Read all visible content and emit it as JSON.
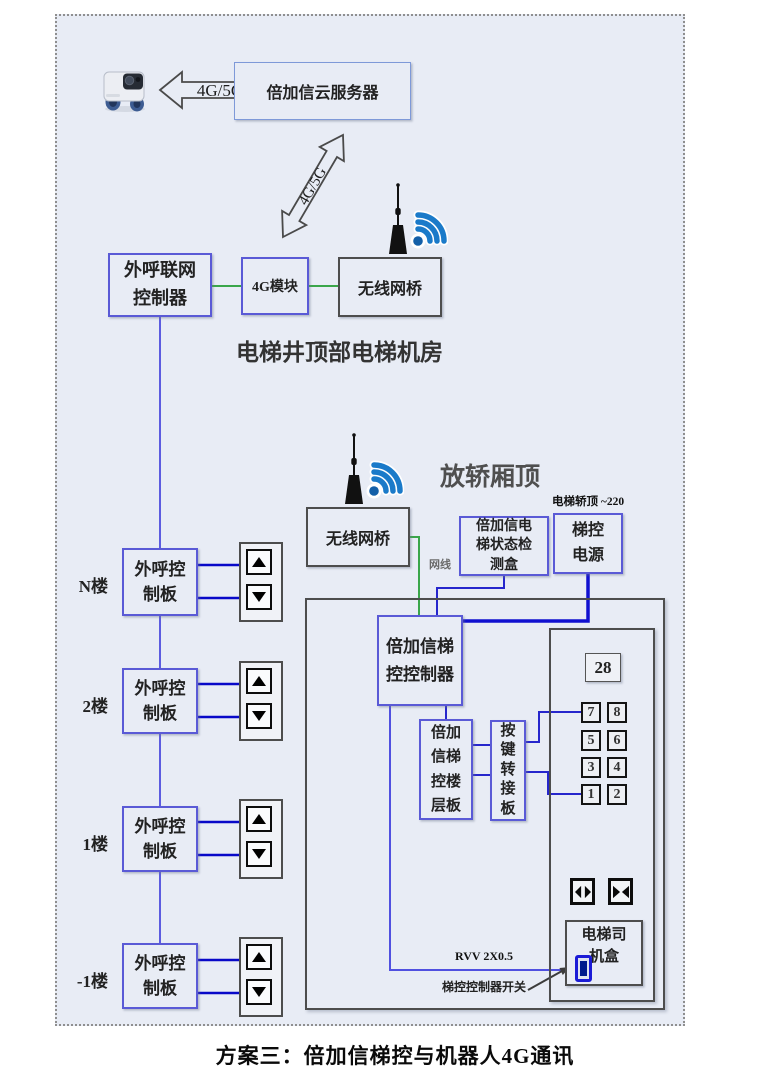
{
  "caption": "方案三：倍加信梯控与机器人4G通讯",
  "cloud": {
    "robot_icon": "delivery-robot-icon",
    "link_label": "4G/5G",
    "server_label": "倍加信云服务器",
    "downlink_label": "4G/5G"
  },
  "machine_room": {
    "room_label": "电梯井顶部电梯机房",
    "caller_gateway": "外呼联网\n控制器",
    "module_4g": "4G模块",
    "wireless_bridge": "无线网桥"
  },
  "car_top": {
    "area_label": "放轿厢顶",
    "wireless_bridge": "无线网桥",
    "power_note": "电梯轿顶 ~220",
    "status_box": "倍加信电\n梯状态检\n测盒",
    "power_box": "梯控\n电源",
    "cable_label": "网线"
  },
  "floors": [
    {
      "label": "N楼",
      "board": "外呼控\n制板"
    },
    {
      "label": "2楼",
      "board": "外呼控\n制板"
    },
    {
      "label": "1楼",
      "board": "外呼控\n制板"
    },
    {
      "label": "-1楼",
      "board": "外呼控\n制板"
    }
  ],
  "car": {
    "controller": "倍加信梯\n控控制器",
    "floor_board": "倍加\n信梯\n控楼\n层板",
    "key_adapter": "按\n键\n转\n接\n板",
    "display_value": "28",
    "buttons": [
      "7",
      "8",
      "5",
      "6",
      "3",
      "4",
      "1",
      "2"
    ],
    "driver_box": "电梯司\n机盒",
    "cable_label": "RVV 2X0.5",
    "switch_label": "梯控控制器开关"
  },
  "colors": {
    "background": "#e8ecf5",
    "blue_border": "#5a5ad6",
    "gray_border": "#4d4d4d",
    "green_wire": "#3aa64a",
    "blue_wire": "#2626cc",
    "dark_blue_wire": "#0808c8",
    "wifi_blue": "#1a7ac9"
  }
}
